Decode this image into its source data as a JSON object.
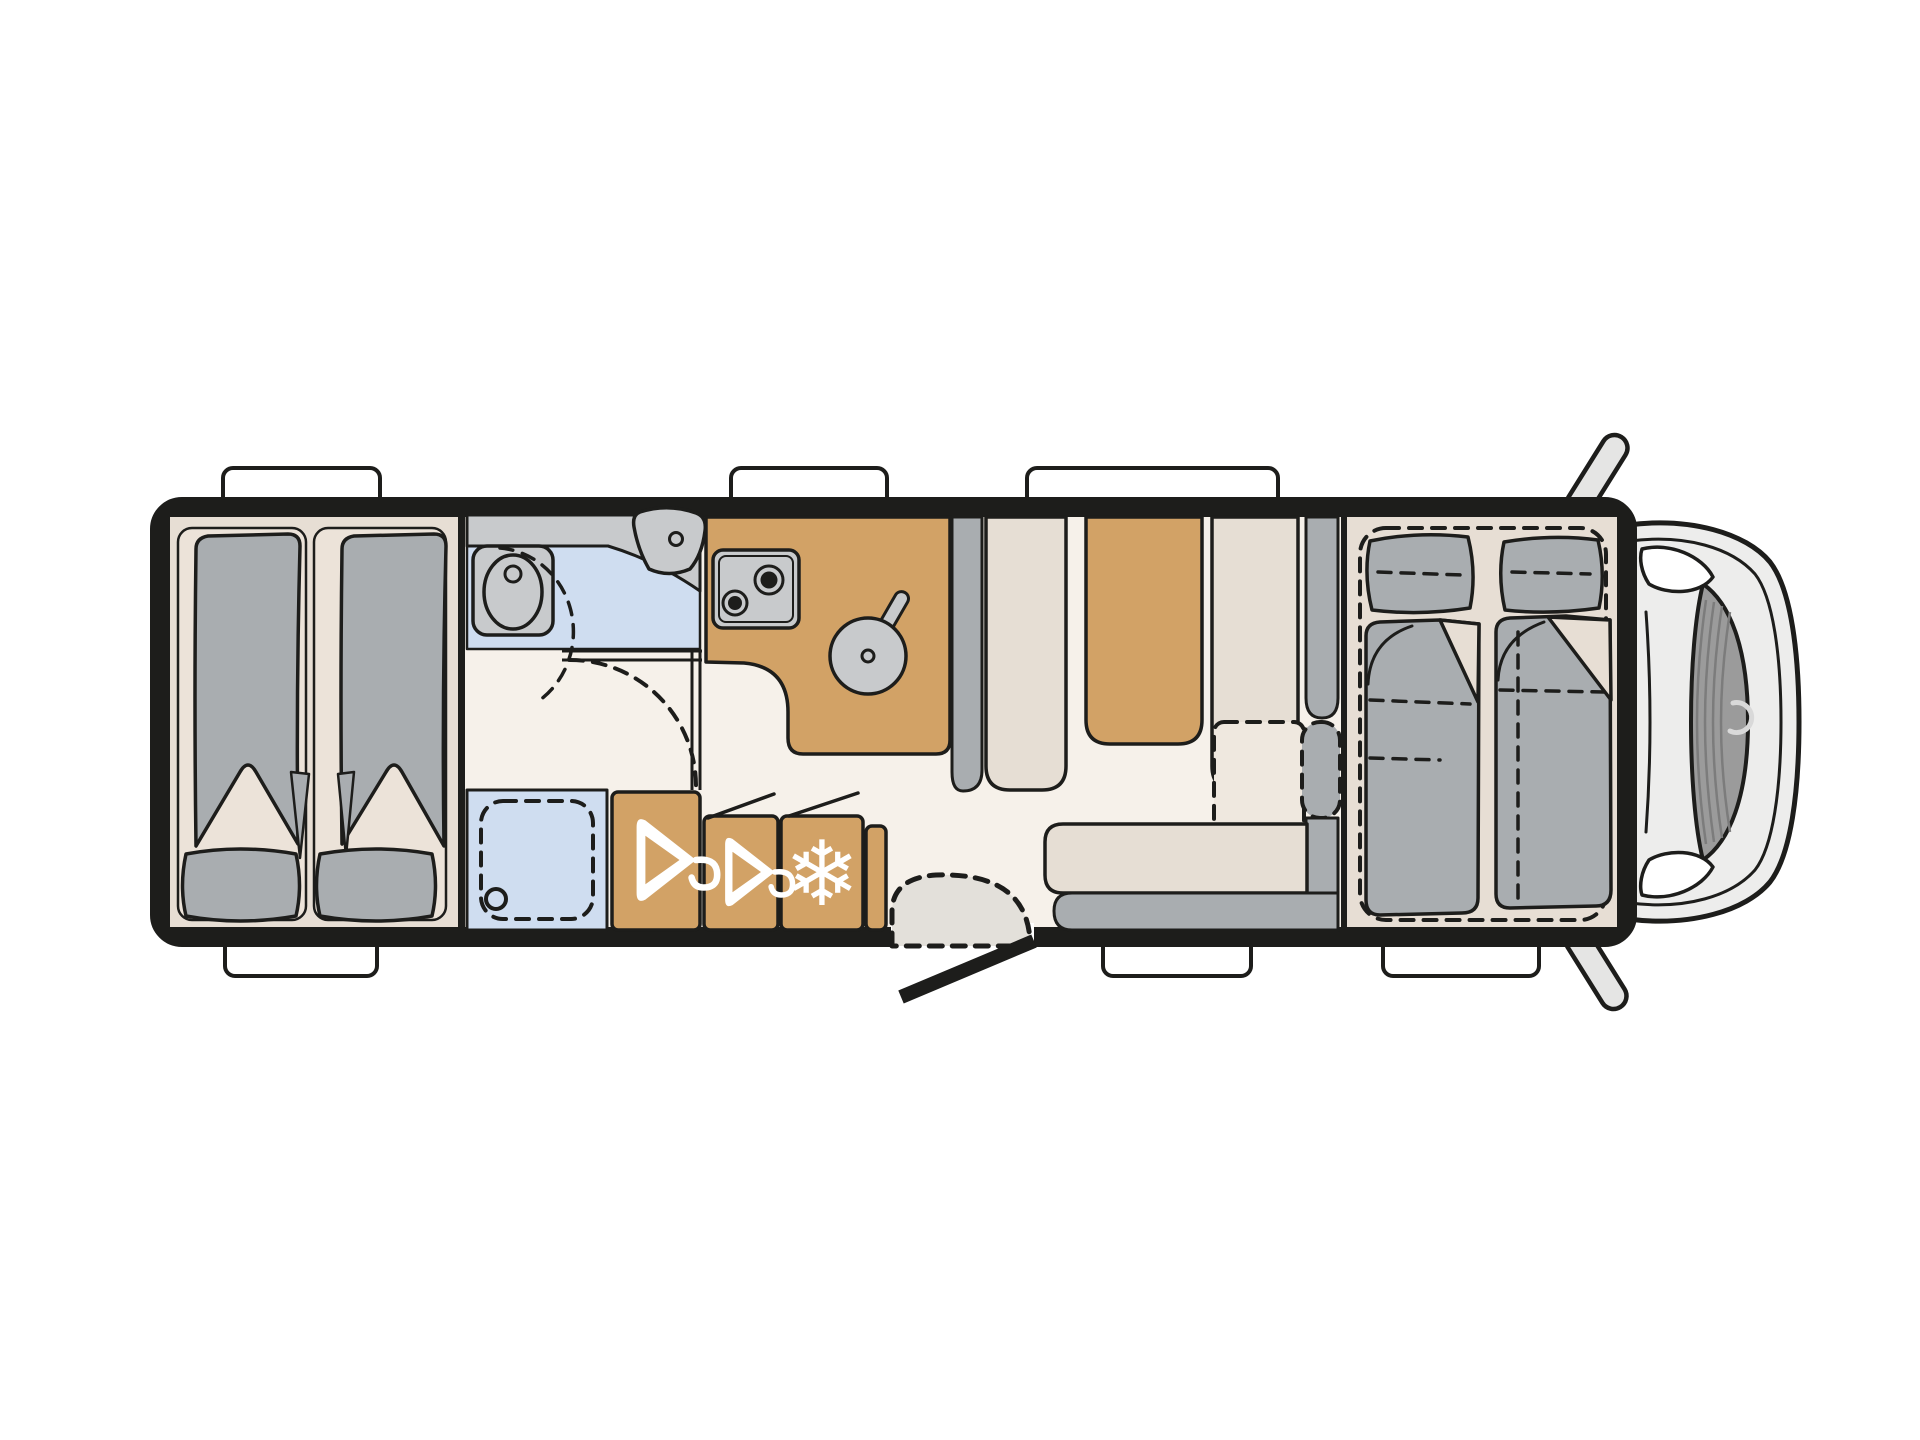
{
  "palette": {
    "bg": "#ffffff",
    "line": "#1d1d1b",
    "wall": "#1d1d1b",
    "floor": "#f6f1ea",
    "floor_bedroom": "#e7ded4",
    "mattress": "#ece3d9",
    "tan": "#d2a266",
    "blue": "#cfddf0",
    "gray_light": "#c8cacc",
    "gray_mid": "#a9adb0",
    "seat_beige": "#e6ded4",
    "seat_beige_light": "#efe8df",
    "door_swing": "#e3e0da",
    "cab_body": "#ededec",
    "cab_inner": "#e7e7e6",
    "windshield": "#9b9b9b",
    "windshield_line": "#7c7c7c",
    "mirror": "#e5e5e4",
    "white": "#ffffff"
  },
  "icons": {
    "wardrobe": "hanger-icon",
    "fridge": "snowflake-icon",
    "snowflake_glyph": "❄"
  }
}
